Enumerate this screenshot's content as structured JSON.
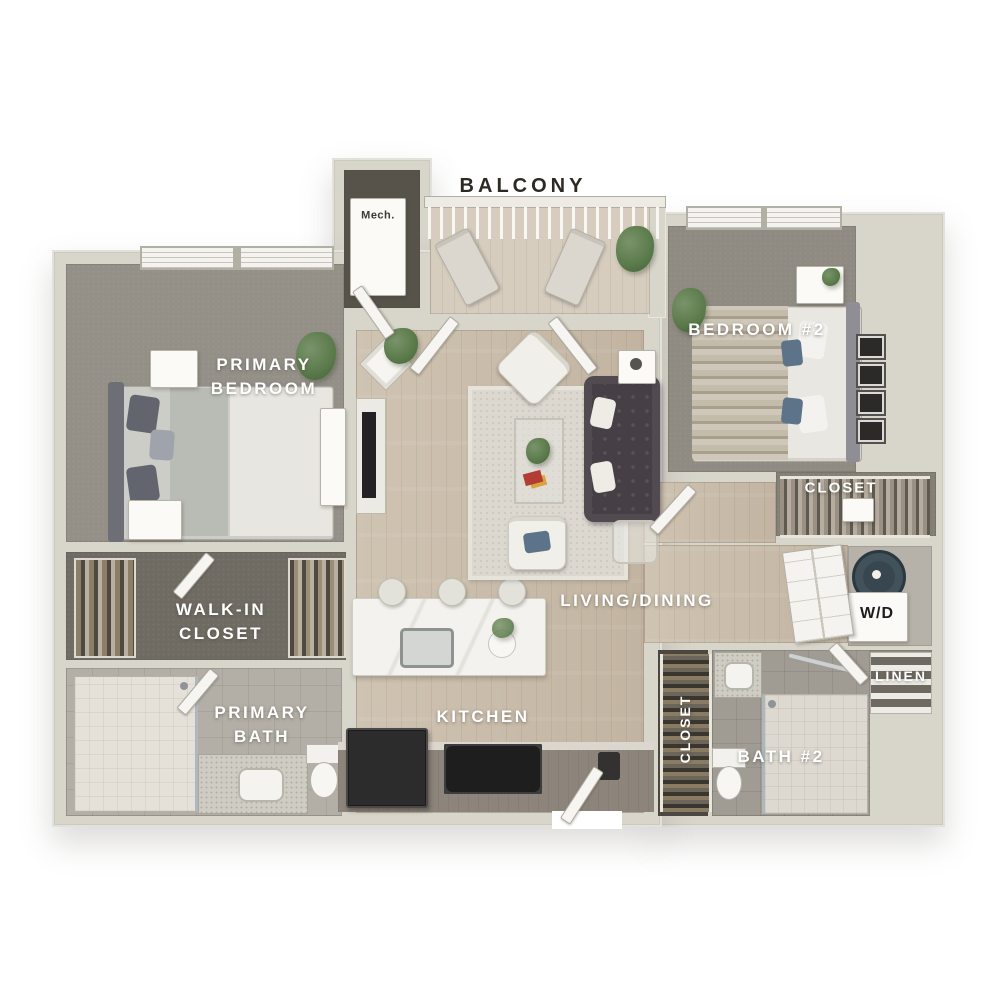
{
  "floorplan": {
    "type": "apartment-3d-floor-plan",
    "labels": {
      "balcony": "BALCONY",
      "mech": "Mech.",
      "primary_bedroom": "PRIMARY\nBEDROOM",
      "bedroom2": "BEDROOM #2",
      "closet_bedroom2": "CLOSET",
      "wd": "W/D",
      "linen": "LINEN",
      "bath2": "BATH #2",
      "hall_closet": "CLOSET",
      "living_dining": "LIVING/DINING",
      "kitchen": "KITCHEN",
      "walkin_closet": "WALK-IN\nCLOSET",
      "primary_bath": "PRIMARY\nBATH"
    },
    "colors": {
      "background": "#ffffff",
      "wall": "#d8d5cb",
      "wood_floor": "#c9bcab",
      "balcony_floor": "#d6cdbf",
      "bedroom_carpet": "#949088",
      "closet_carpet": "#6f6b63",
      "bath_tile": "#b3aea6",
      "bath2_tile": "#a09b93",
      "sofa": "#463f45",
      "accent_pillow_blue": "#5d7389",
      "plant_green": "#5a7a4a",
      "washer": "#38474f",
      "label_light": "#ffffff",
      "label_dark": "#2d2a26"
    }
  }
}
